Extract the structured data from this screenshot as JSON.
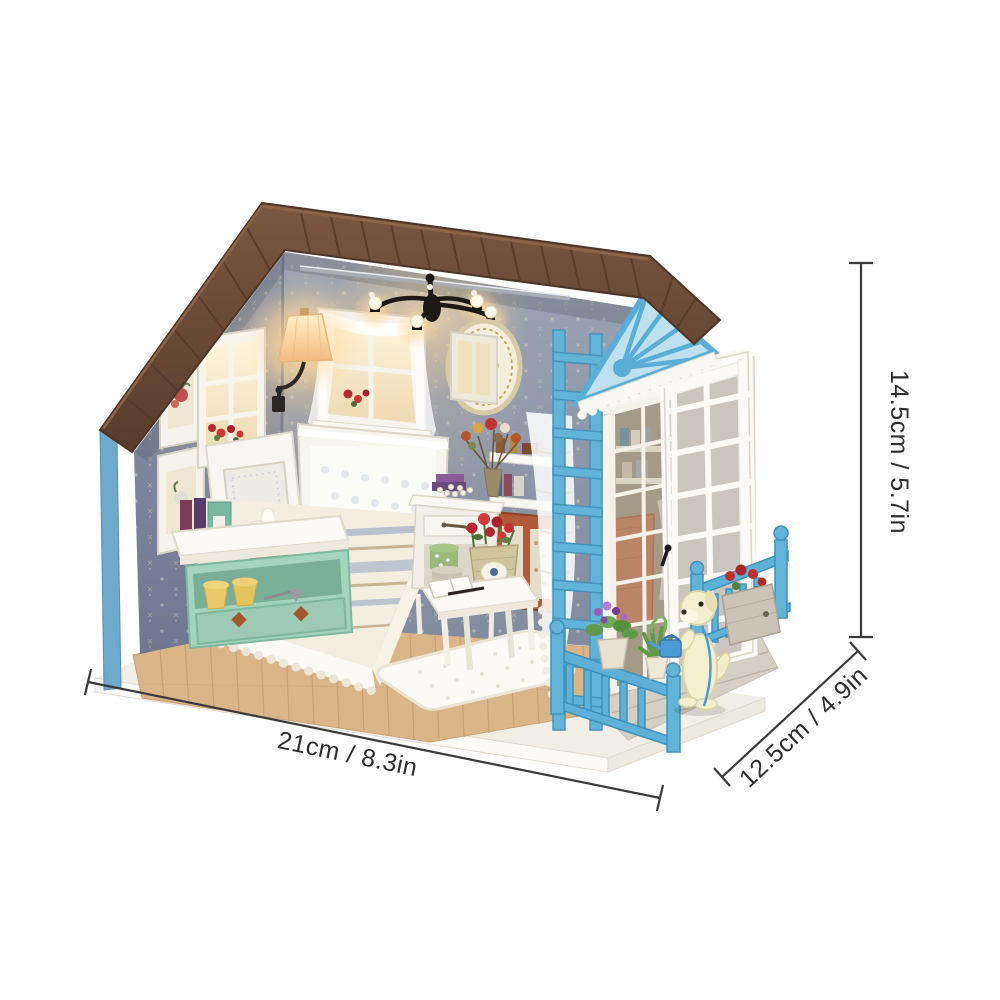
{
  "image": {
    "kind": "product-photo",
    "subject": "DIY miniature dollhouse kit - cozy bedroom room box with covered porch, puppy figurine and LED lights",
    "background": "#ffffff"
  },
  "annotations": {
    "width": {
      "label": "21cm / 8.3in"
    },
    "depth": {
      "label": "12.5cm / 4.9in"
    },
    "height": {
      "label": "14.5cm / 5.7in"
    }
  },
  "palette": {
    "roof_brown": "#6a4a33",
    "trim_blue": "#5fb0d6",
    "wallpaper_blue_gray": "#8a93a6",
    "floor_wood": "#d9b587",
    "porch_deck": "#d6d0c4",
    "base_white": "#f7f5ef",
    "mint_green": "#a4d4bd",
    "cabinet_rust": "#b05a38",
    "lace_white": "#fbfaf6",
    "glow_warm": "#ffd79a",
    "dog_cream": "#f4efce",
    "dimension_line": "#3a3a3a"
  },
  "scene": {
    "elements": [
      "gabled plank roof",
      "sunburst pediment",
      "wallpapered walls",
      "wall sconce lamp",
      "chandelier with glowing bulbs",
      "lace window",
      "oval wall medallion",
      "picture frames",
      "side windows with red flowers",
      "bed with striped duvet and lace pillows",
      "mint storage bench with books and flower pot",
      "nightstand with hat boxes",
      "hutch cabinet with dried bouquet",
      "coffee table with open book and rose basket",
      "woven rug",
      "lace curtain",
      "blue trellis",
      "open french door",
      "porch railings",
      "puppy with watering can",
      "potted plants",
      "wood floor",
      "white display base"
    ]
  }
}
